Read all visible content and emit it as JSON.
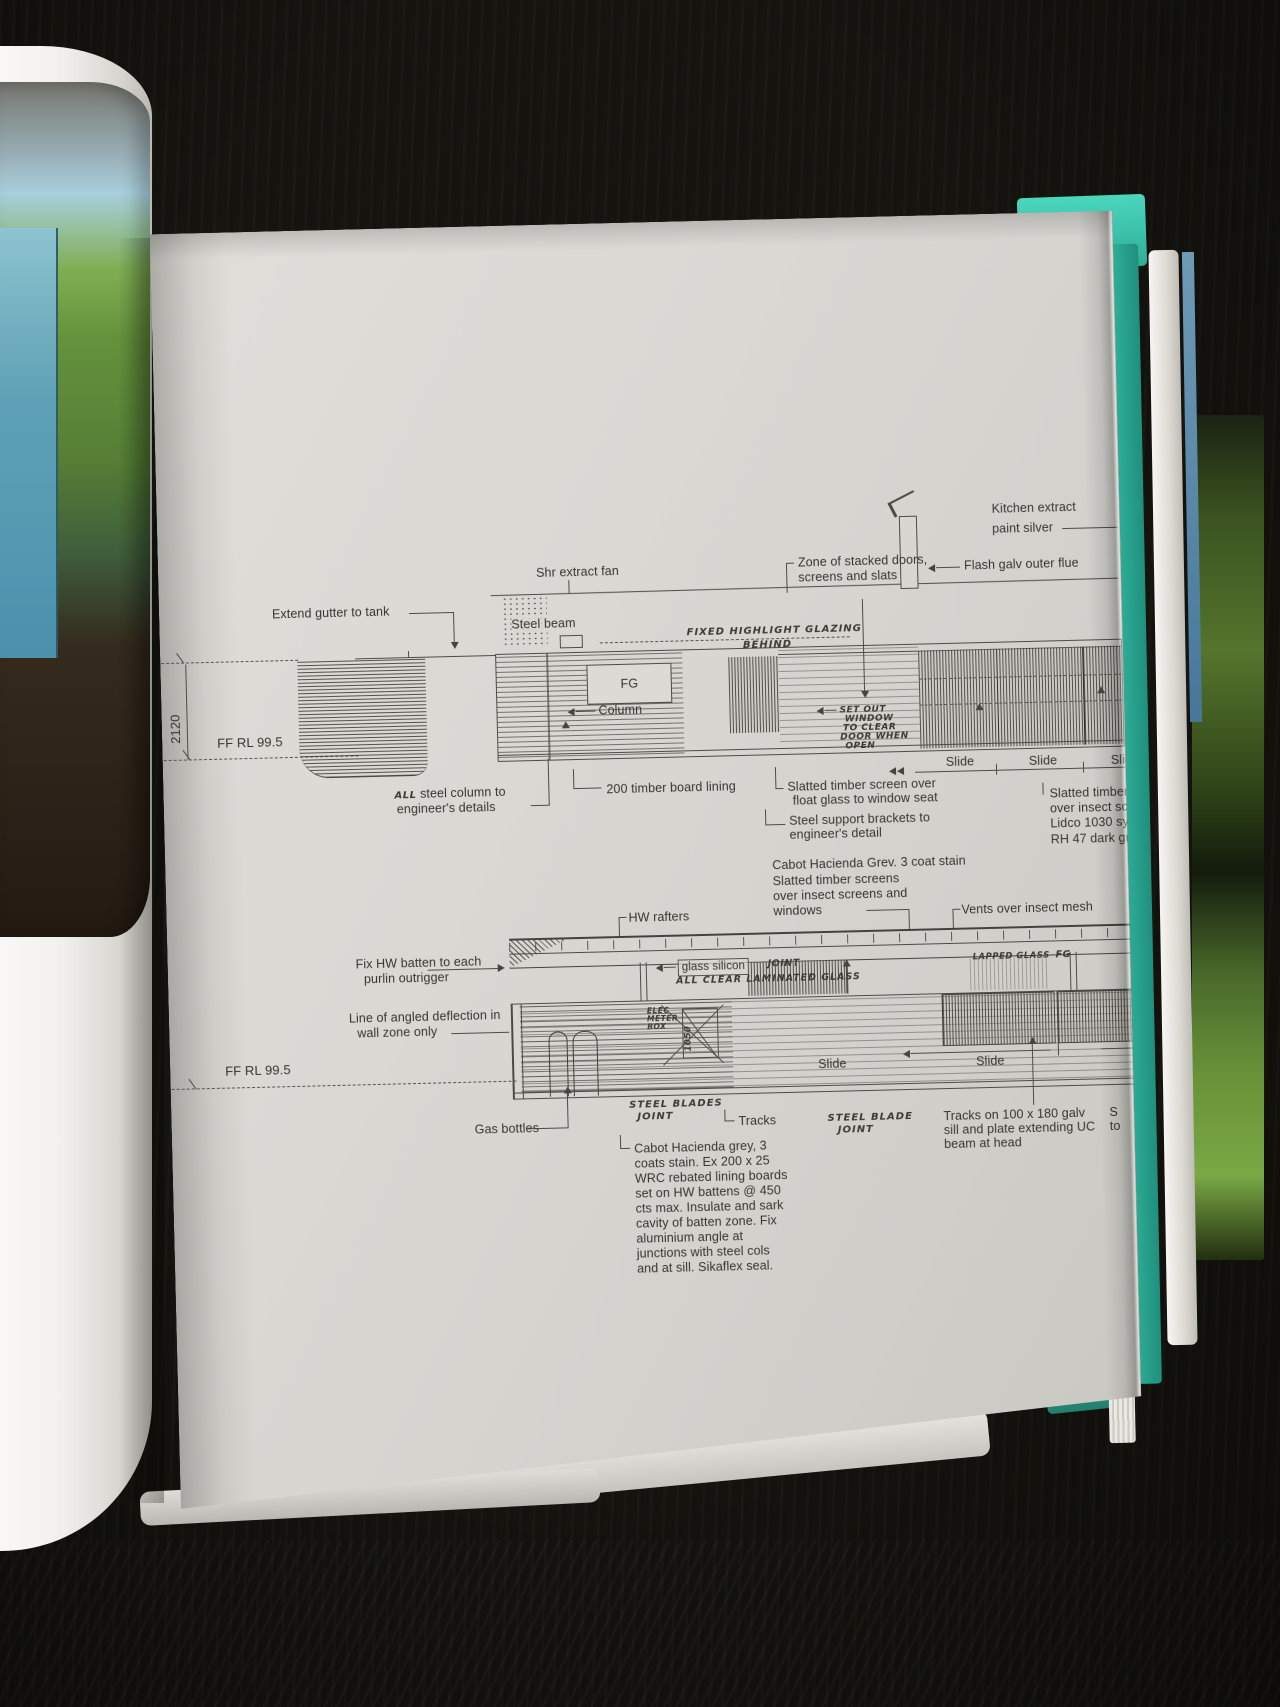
{
  "scene": {
    "table_color": "#15140f",
    "page_color": "#d8d6d1",
    "cover_color": "#33c1a9",
    "photo_green": "#5d8f3a",
    "photo_blue": "#6fb0c6"
  },
  "upper": {
    "labels": {
      "extend_gutter": "Extend gutter to tank",
      "shr_extract_fan": "Shr extract fan",
      "steel_beam": "Steel beam",
      "zone_line1": "Zone of stacked doors,",
      "zone_line2": "screens and slats",
      "kitchen_line1": "Kitchen extract",
      "kitchen_line2": "paint silver",
      "flash_galv": "Flash galv outer flue",
      "fixed_highlight1": "FIXED HIGHLIGHT GLAZING",
      "fixed_highlight2": "BEHIND",
      "fg": "FG",
      "column": "Column",
      "set_out": [
        "SET OUT",
        "WINDOW",
        "TO CLEAR",
        "DOOR WHEN",
        "OPEN"
      ],
      "dim_height": "2120",
      "datum": "FF RL 99.5",
      "slides": [
        "Slide",
        "Slide",
        "Slide"
      ],
      "all_hand": "ALL",
      "steel_column1": "steel column to",
      "steel_column2": "engineer's details",
      "timber_lining": "200 timber board lining",
      "slatted1": "Slatted timber screen over",
      "slatted2": "float glass to window seat",
      "support1": "Steel support brackets to",
      "support2": "engineer's detail",
      "right_block": [
        "Slatted timber s",
        "over insect scre",
        "Lidco 1030 syst",
        "RH 47 dark grey."
      ]
    }
  },
  "mid": {
    "labels": {
      "cabot": [
        "Cabot Hacienda Grev. 3  coat stain",
        "Slatted timber screens",
        "over insect screens and",
        "windows"
      ],
      "hw_rafters": "HW rafters",
      "vents": "Vents over insect mesh",
      "fix_hw1": "Fix HW batten to each",
      "fix_hw2": "purlin outrigger",
      "glass_silicon": "glass silicon",
      "joint_hand": "JOINT",
      "all_clear_hand": "ALL CLEAR LAMINATED GLASS",
      "lapped_hand": "LAPPED GLASS",
      "fg_hand": "FG"
    }
  },
  "lower": {
    "labels": {
      "line_angled1": "Line of angled deflection in",
      "line_angled2": "wall zone only",
      "datum": "FF RL 99.5",
      "elec": [
        "ELEC",
        "METER",
        "BOX"
      ],
      "dim_1050": "1050",
      "slides": [
        "Slide",
        "Slide"
      ],
      "gas_bottles": "Gas bottles",
      "blades1a": "STEEL BLADES",
      "blades1b": "JOINT",
      "tracks": "Tracks",
      "blades2a": "STEEL BLADE",
      "blades2b": "JOINT",
      "tracks_on": [
        "Tracks on 100 x 180 galv",
        "sill and plate extending UC",
        "beam at head"
      ],
      "clipped": [
        "S",
        "to"
      ],
      "cabot_para": [
        "Cabot Hacienda grey, 3",
        "coats stain. Ex  200 x 25",
        "WRC rebated lining boards",
        "set on HW battens @ 450",
        "cts max. Insulate and sark",
        "cavity of batten zone. Fix",
        "aluminium angle at",
        "junctions with steel cols",
        "and at sill. Sikaflex seal."
      ]
    }
  }
}
